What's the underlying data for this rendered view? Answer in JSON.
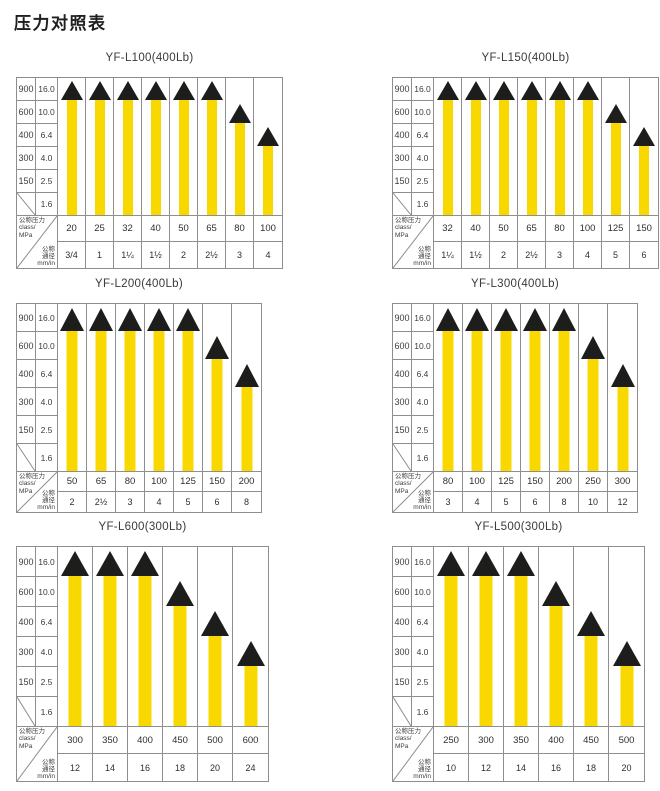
{
  "page_title": "压力对照表",
  "colors": {
    "bar": "#F9D800",
    "triangle": "#1D1D1B",
    "grid": "#8E8E8E",
    "text": "#3C3C3C"
  },
  "axis": {
    "class_ticks": [
      "900",
      "600",
      "400",
      "300",
      "150"
    ],
    "mpa_ticks": [
      "16.0",
      "10.0",
      "6.4",
      "4.0",
      "2.5",
      "1.6"
    ],
    "corner": {
      "pressure_lines": [
        "公称压力",
        "class/",
        "MPa"
      ],
      "diameter_lines": [
        "公称",
        "通径",
        "mm/in"
      ]
    }
  },
  "chart_data": [
    {
      "type": "bar",
      "title": "YF-L100(400Lb)",
      "x_mm": [
        "20",
        "25",
        "32",
        "40",
        "50",
        "65",
        "80",
        "100"
      ],
      "x_in": [
        "3/4",
        "1",
        "1¼",
        "1½",
        "2",
        "2½",
        "3",
        "4"
      ],
      "pressure_mpa": [
        "16.0",
        "16.0",
        "16.0",
        "16.0",
        "16.0",
        "16.0",
        "10.0",
        "6.4"
      ]
    },
    {
      "type": "bar",
      "title": "YF-L150(400Lb)",
      "x_mm": [
        "32",
        "40",
        "50",
        "65",
        "80",
        "100",
        "125",
        "150"
      ],
      "x_in": [
        "1¼",
        "1½",
        "2",
        "2½",
        "3",
        "4",
        "5",
        "6"
      ],
      "pressure_mpa": [
        "16.0",
        "16.0",
        "16.0",
        "16.0",
        "16.0",
        "16.0",
        "10.0",
        "6.4"
      ]
    },
    {
      "type": "bar",
      "title": "YF-L200(400Lb)",
      "x_mm": [
        "50",
        "65",
        "80",
        "100",
        "125",
        "150",
        "200"
      ],
      "x_in": [
        "2",
        "2½",
        "3",
        "4",
        "5",
        "6",
        "8"
      ],
      "pressure_mpa": [
        "16.0",
        "16.0",
        "16.0",
        "16.0",
        "16.0",
        "10.0",
        "6.4"
      ]
    },
    {
      "type": "bar",
      "title": "YF-L300(400Lb)",
      "x_mm": [
        "80",
        "100",
        "125",
        "150",
        "200",
        "250",
        "300"
      ],
      "x_in": [
        "3",
        "4",
        "5",
        "6",
        "8",
        "10",
        "12"
      ],
      "pressure_mpa": [
        "16.0",
        "16.0",
        "16.0",
        "16.0",
        "16.0",
        "10.0",
        "6.4"
      ]
    },
    {
      "type": "bar",
      "title": "YF-L600(300Lb)",
      "x_mm": [
        "300",
        "350",
        "400",
        "450",
        "500",
        "600"
      ],
      "x_in": [
        "12",
        "14",
        "16",
        "18",
        "20",
        "24"
      ],
      "pressure_mpa": [
        "16.0",
        "16.0",
        "16.0",
        "10.0",
        "6.4",
        "4.0"
      ]
    },
    {
      "type": "bar",
      "title": "YF-L500(300Lb)",
      "x_mm": [
        "250",
        "300",
        "350",
        "400",
        "450",
        "500"
      ],
      "x_in": [
        "10",
        "12",
        "14",
        "16",
        "18",
        "20"
      ],
      "pressure_mpa": [
        "16.0",
        "16.0",
        "16.0",
        "10.0",
        "6.4",
        "4.0"
      ]
    }
  ]
}
